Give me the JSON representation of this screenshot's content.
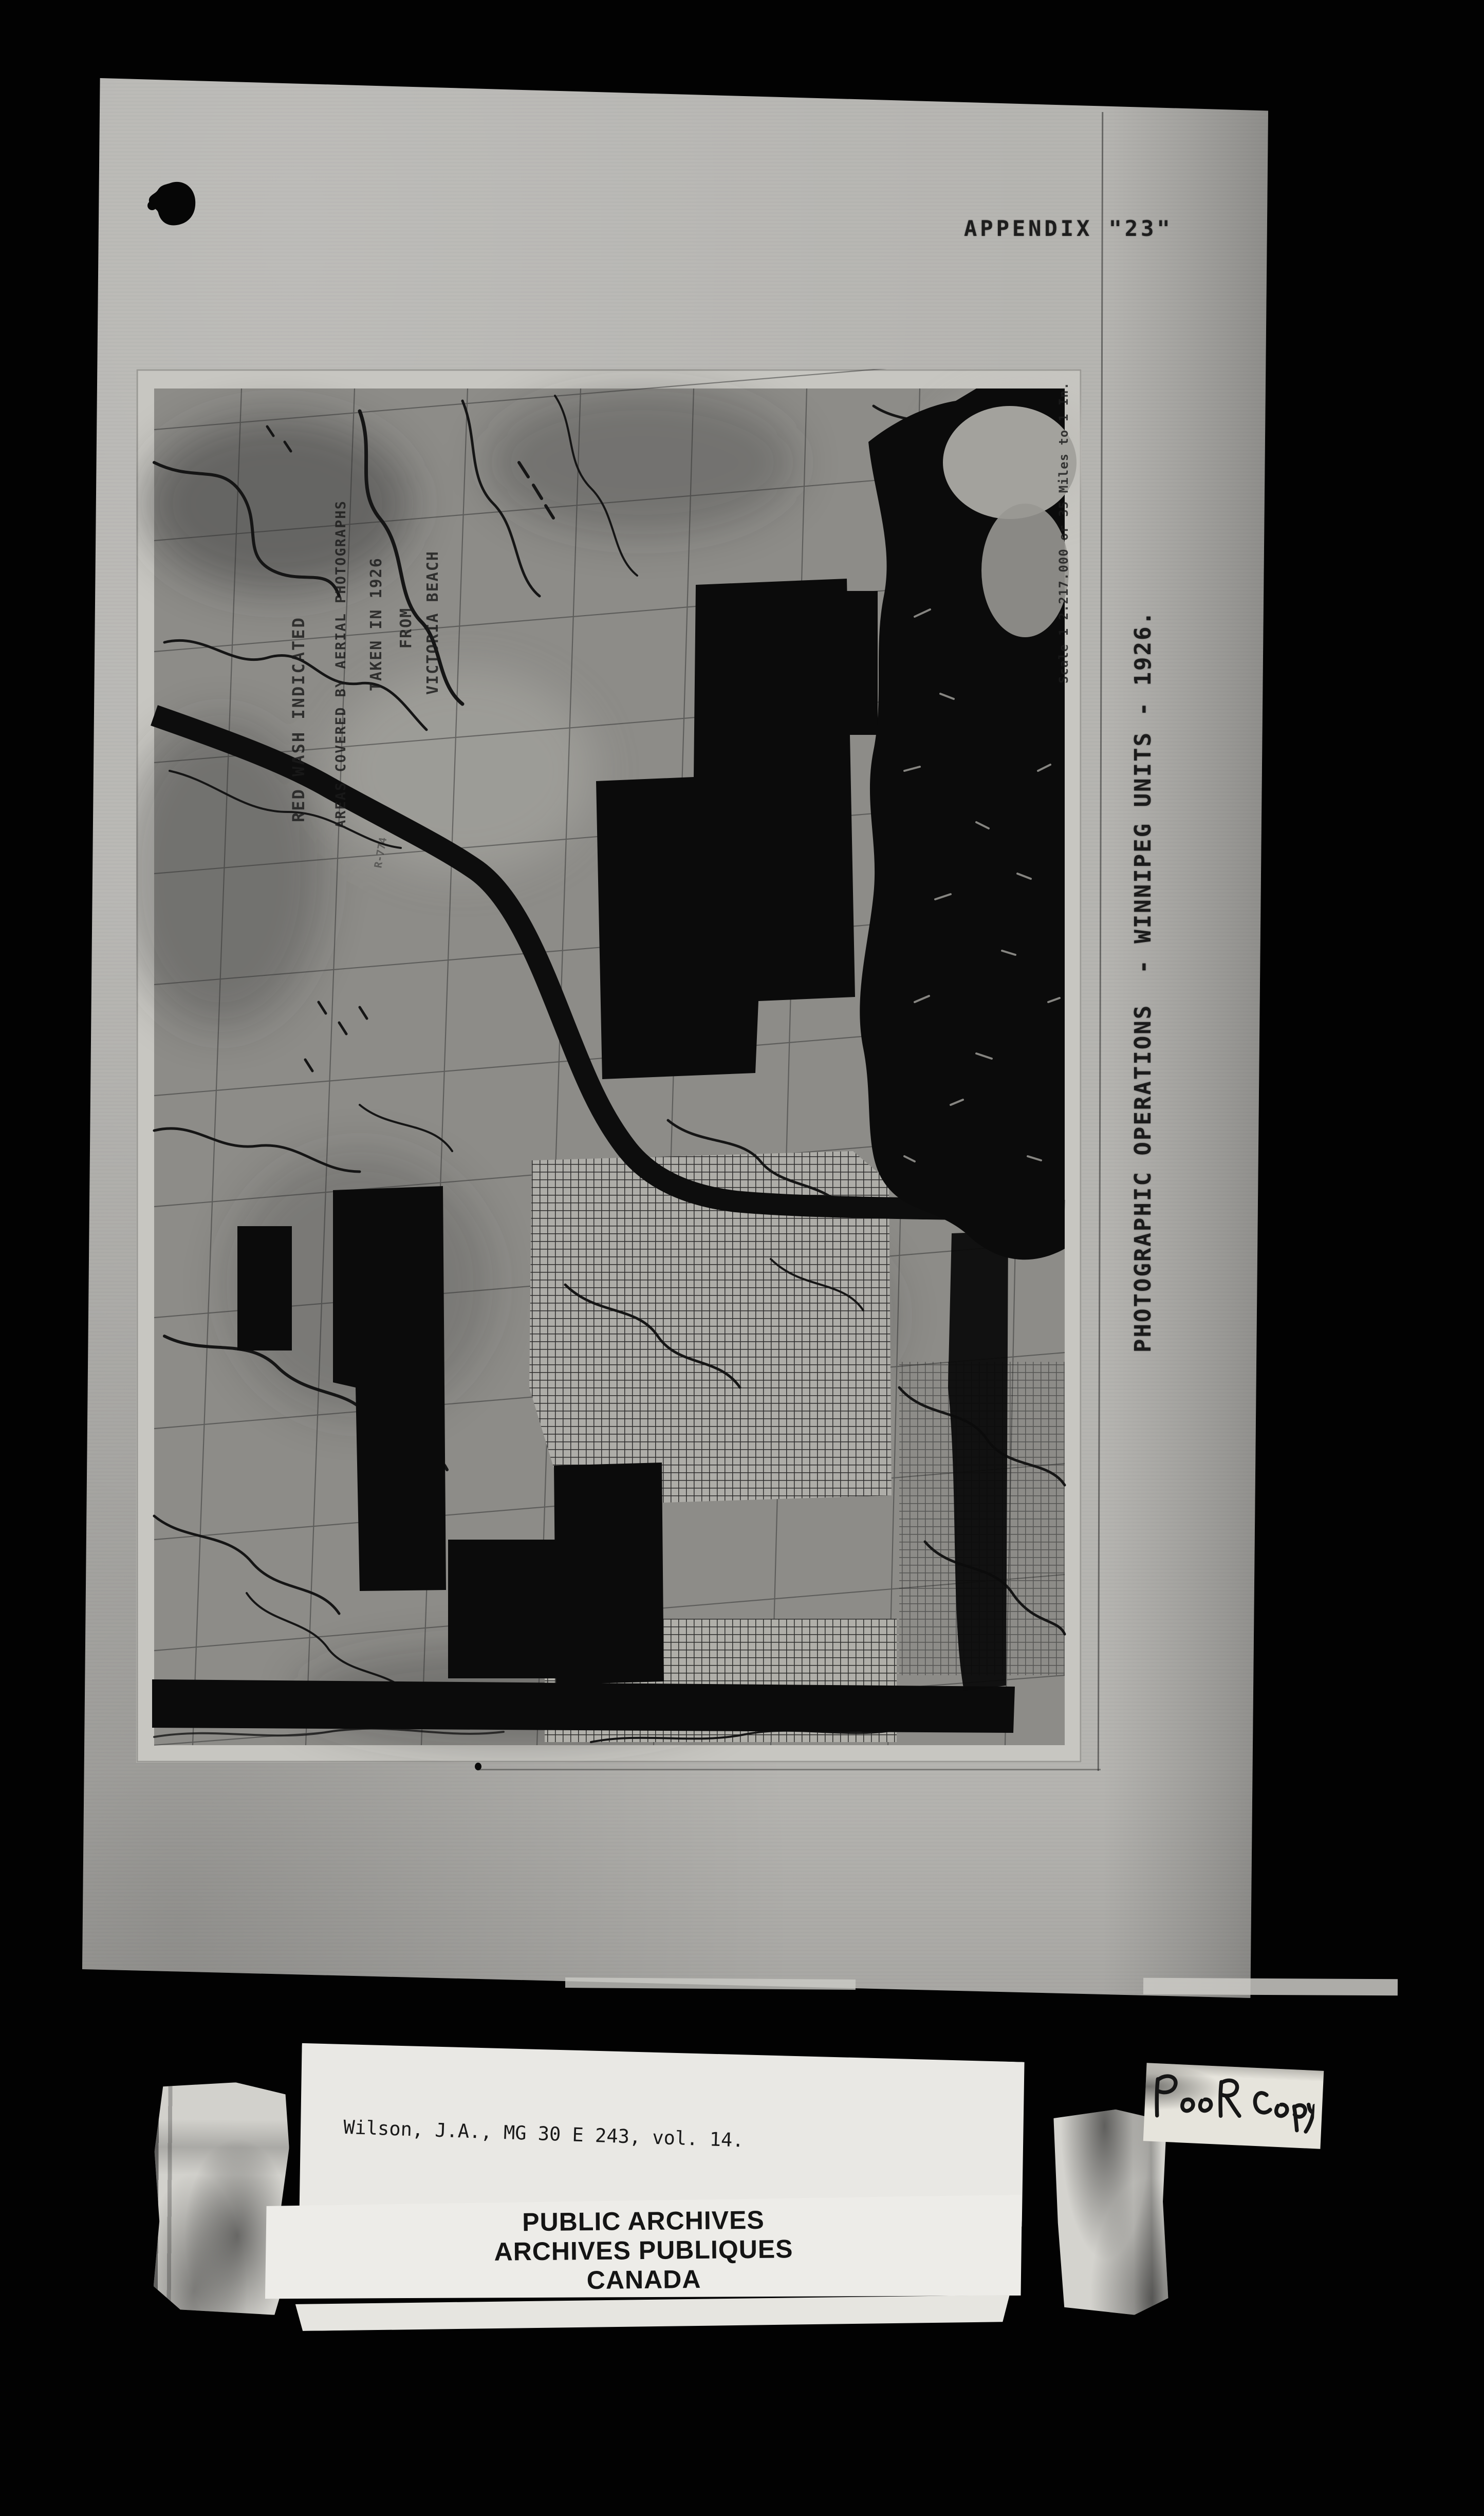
{
  "document": {
    "appendix_label": "APPENDIX \"23\"",
    "side_caption": "PHOTOGRAPHIC OPERATIONS  - WINNIPEG UNITS - 1926."
  },
  "map_photo": {
    "legend_columns": [
      "RED WASH INDICATED",
      "AREAS COVERED BY AERIAL PHOTOGRAPHS",
      "TAKEN IN 1926",
      "FROM",
      "VICTORIA BEACH"
    ],
    "scale_note": "Scale 1 2.217.000 or 35 Miles to 1 In.",
    "pencil_note": "R-774"
  },
  "catalog_label": {
    "line1": "Wilson, J.A., MG 30 E 243, vol. 14.",
    "line2": "Royal Canadian Air Force, organization and work - Report",
    "line3": "with photographs, 1926."
  },
  "archives_stamp": {
    "line1": "PUBLIC ARCHIVES",
    "line2": "ARCHIVES PUBLIQUES",
    "line3": "CANADA"
  },
  "handwritten_note": "Poor Copy",
  "colors": {
    "background": "#000000",
    "paper": "#b6b5b1",
    "photo_margin": "#c7c6c1",
    "map_field": "#8d8c88",
    "ink": "#141414",
    "label_paper": "#e9e8e4"
  }
}
